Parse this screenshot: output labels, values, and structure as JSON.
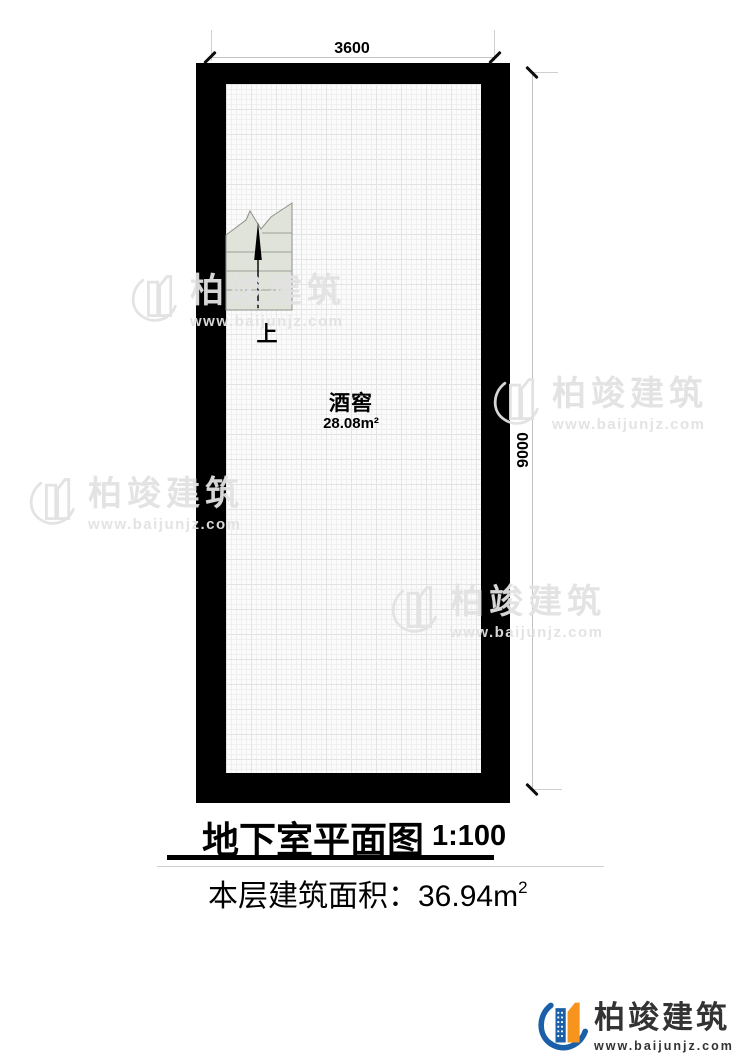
{
  "title": {
    "text": "地下室平面图",
    "scale": "1:100"
  },
  "area_line": {
    "label": "本层建筑面积：",
    "value": "36.94m",
    "sup": "2"
  },
  "dimensions": {
    "top": "3600",
    "right": "9000"
  },
  "plan": {
    "room": {
      "name": "酒窖",
      "area": "28.08m²"
    },
    "stairs": {
      "direction_label": "上"
    }
  },
  "watermark": {
    "name": "柏竣建筑",
    "url": "www.baijunjz.com"
  },
  "logo": {
    "name": "柏竣建筑",
    "url": "www.baijunjz.com"
  },
  "colors": {
    "wall": "#000000",
    "stair_fill": "#dfe3da",
    "logo_blue": "#1a5fa8",
    "logo_orange": "#f7941d",
    "watermark": "#e2e2e2"
  }
}
